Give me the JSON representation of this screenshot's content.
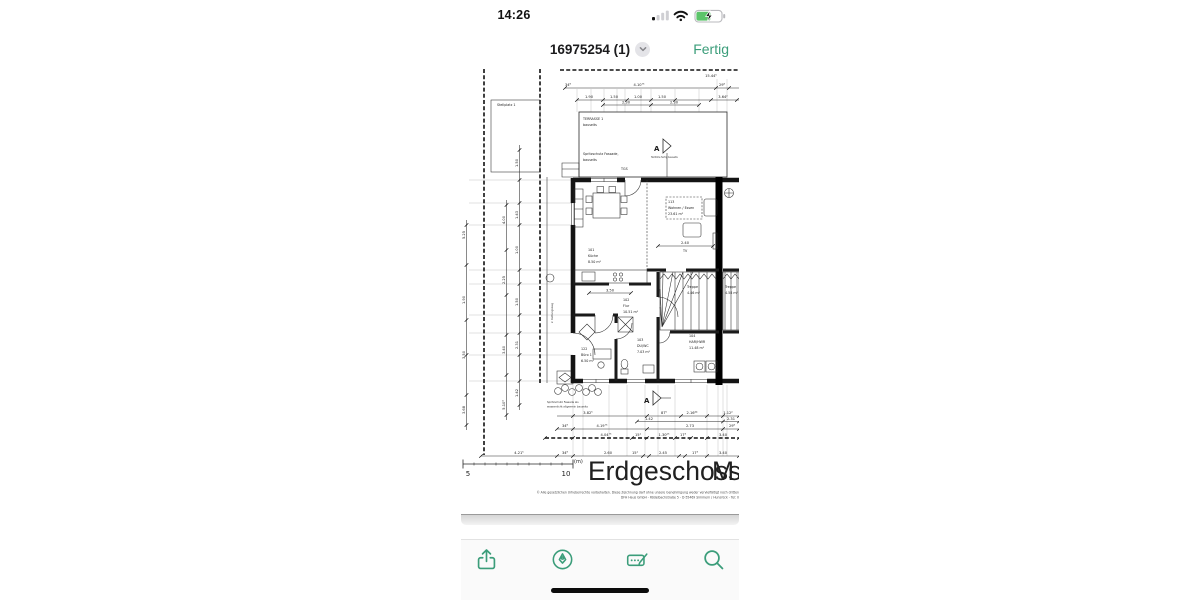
{
  "status_bar": {
    "time": "14:26"
  },
  "nav": {
    "title": "16975254 (1)",
    "done_label": "Fertig"
  },
  "toolbar": {
    "icons": [
      "share-icon",
      "markup-icon",
      "autofill-signature-icon",
      "search-icon"
    ]
  },
  "colors": {
    "accent": "#3b9d7a",
    "battery_green": "#5cc46a"
  },
  "plan": {
    "title": "Erdgeschoss",
    "scale_label": "M 1:",
    "scale_bar": {
      "five": "5",
      "ten": "10",
      "unit": "(m)"
    },
    "copyright_line1": "© Alle gesetzlichen Urheberrechte vorbehalten. Diese Zeichnung darf ohne unsere Genehmigung weder vervielfältigt noch dritten",
    "copyright_line2": "DFH Haus GmbH - Rödelbachstraße 5 - D-55469 Simmern / Hunsrück - Tel: 0",
    "labels": {
      "stellplatz": "Stellplatz 1",
      "terrasse1": "TERRASSE 1",
      "terrasse2": "bauseits",
      "spritz1": "Spritzschutz Fassade,",
      "spritz2": "bauseits",
      "spritz_b1": "Spritzschutz Fassade als",
      "spritz_b2": "wasserdicht allgemein bauseits",
      "teilhoehe": "Teilhöhe fertig bauseits",
      "rettung": "2. Rettungsweg",
      "tgs": "TGS",
      "section": "A",
      "tv": "TV",
      "tv_dim": "2.40",
      "flur_dim": "3.50"
    },
    "rooms": {
      "kueche": {
        "no": "101",
        "name": "Küche",
        "area": "8.50 m²"
      },
      "wohnen": {
        "no": "113",
        "name": "Wohnen / Essen",
        "area": "23.61 m²"
      },
      "flur": {
        "no": "102",
        "name": "Flur",
        "area": "10.51 m²"
      },
      "buero": {
        "no": "122",
        "name": "Büro 1",
        "area": "6.50 m²"
      },
      "duwc": {
        "no": "103",
        "name": "DU/WC",
        "area": "7.03 m²"
      },
      "har": {
        "no": "104",
        "name": "HAR/HWR",
        "area": "11.48 m²"
      },
      "treppe": {
        "name": "Treppe",
        "area": "4.46 m²"
      },
      "treppe2": {
        "name": "Treppe",
        "area": "4.58 m²"
      }
    },
    "dims": {
      "top": [
        "15.44⁵",
        "34⁸",
        "4.10⁷⁵",
        "29⁸",
        "1.90",
        "1.50",
        "1.00",
        "1.50",
        "3.64²",
        "2.30",
        "2.30"
      ],
      "left": [
        "5.25",
        "1.90",
        "3.50",
        "3.68",
        "4.00",
        "2.25",
        "3.40",
        "5.10⁴",
        "1.50",
        "1.43",
        "1.00",
        "1.50",
        "2.31",
        "1.42"
      ],
      "bottom1": [
        "3.82⁵",
        "87⁵",
        "2.16⁴⁴",
        "1.12²"
      ],
      "bottom2": [
        "1.42",
        "2.31"
      ],
      "bottom3": [
        "34⁸",
        "4.19⁷⁵",
        "2.73",
        "29⁸"
      ],
      "bottom4": [
        "4.04⁷⁵",
        "15¹",
        "1.30²⁵",
        "17³",
        "3.40"
      ],
      "bottom5": [
        "4.21⁵",
        "34⁸",
        "2.60",
        "15¹",
        "2.45",
        "17³",
        "3.40"
      ]
    }
  }
}
